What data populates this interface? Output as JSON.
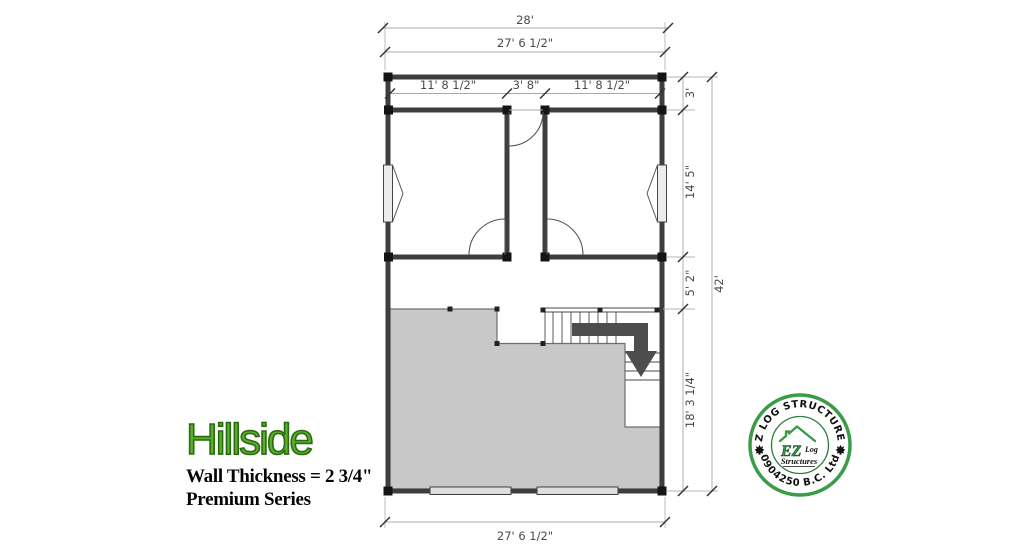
{
  "plan": {
    "dimensions": {
      "overall_width": "28'",
      "wall_width_top": "27' 6 1/2\"",
      "room_left_width": "11' 8 1/2\"",
      "hall_width": "3' 8\"",
      "room_right_width": "11' 8 1/2\"",
      "porch_depth": "3'",
      "rooms_depth": "14' 5\"",
      "open_area_depth": "5' 2\"",
      "loft_depth": "18' 3 1/4\"",
      "overall_depth": "42'",
      "wall_width_bottom": "27' 6 1/2\""
    }
  },
  "title_block": {
    "model_name": "Hillside",
    "wall_thickness": "Wall Thickness = 2 3/4\"",
    "series": "Premium Series",
    "accent_color": "#56b22a"
  },
  "stamp": {
    "arc_top": "EZ LOG STRUCTURES",
    "arc_bottom": "0904250 B.C. Ltd",
    "center_ez": "EZ",
    "center_log": "Log",
    "center_structures": "Structures",
    "ring_color": "#3a9b49"
  }
}
